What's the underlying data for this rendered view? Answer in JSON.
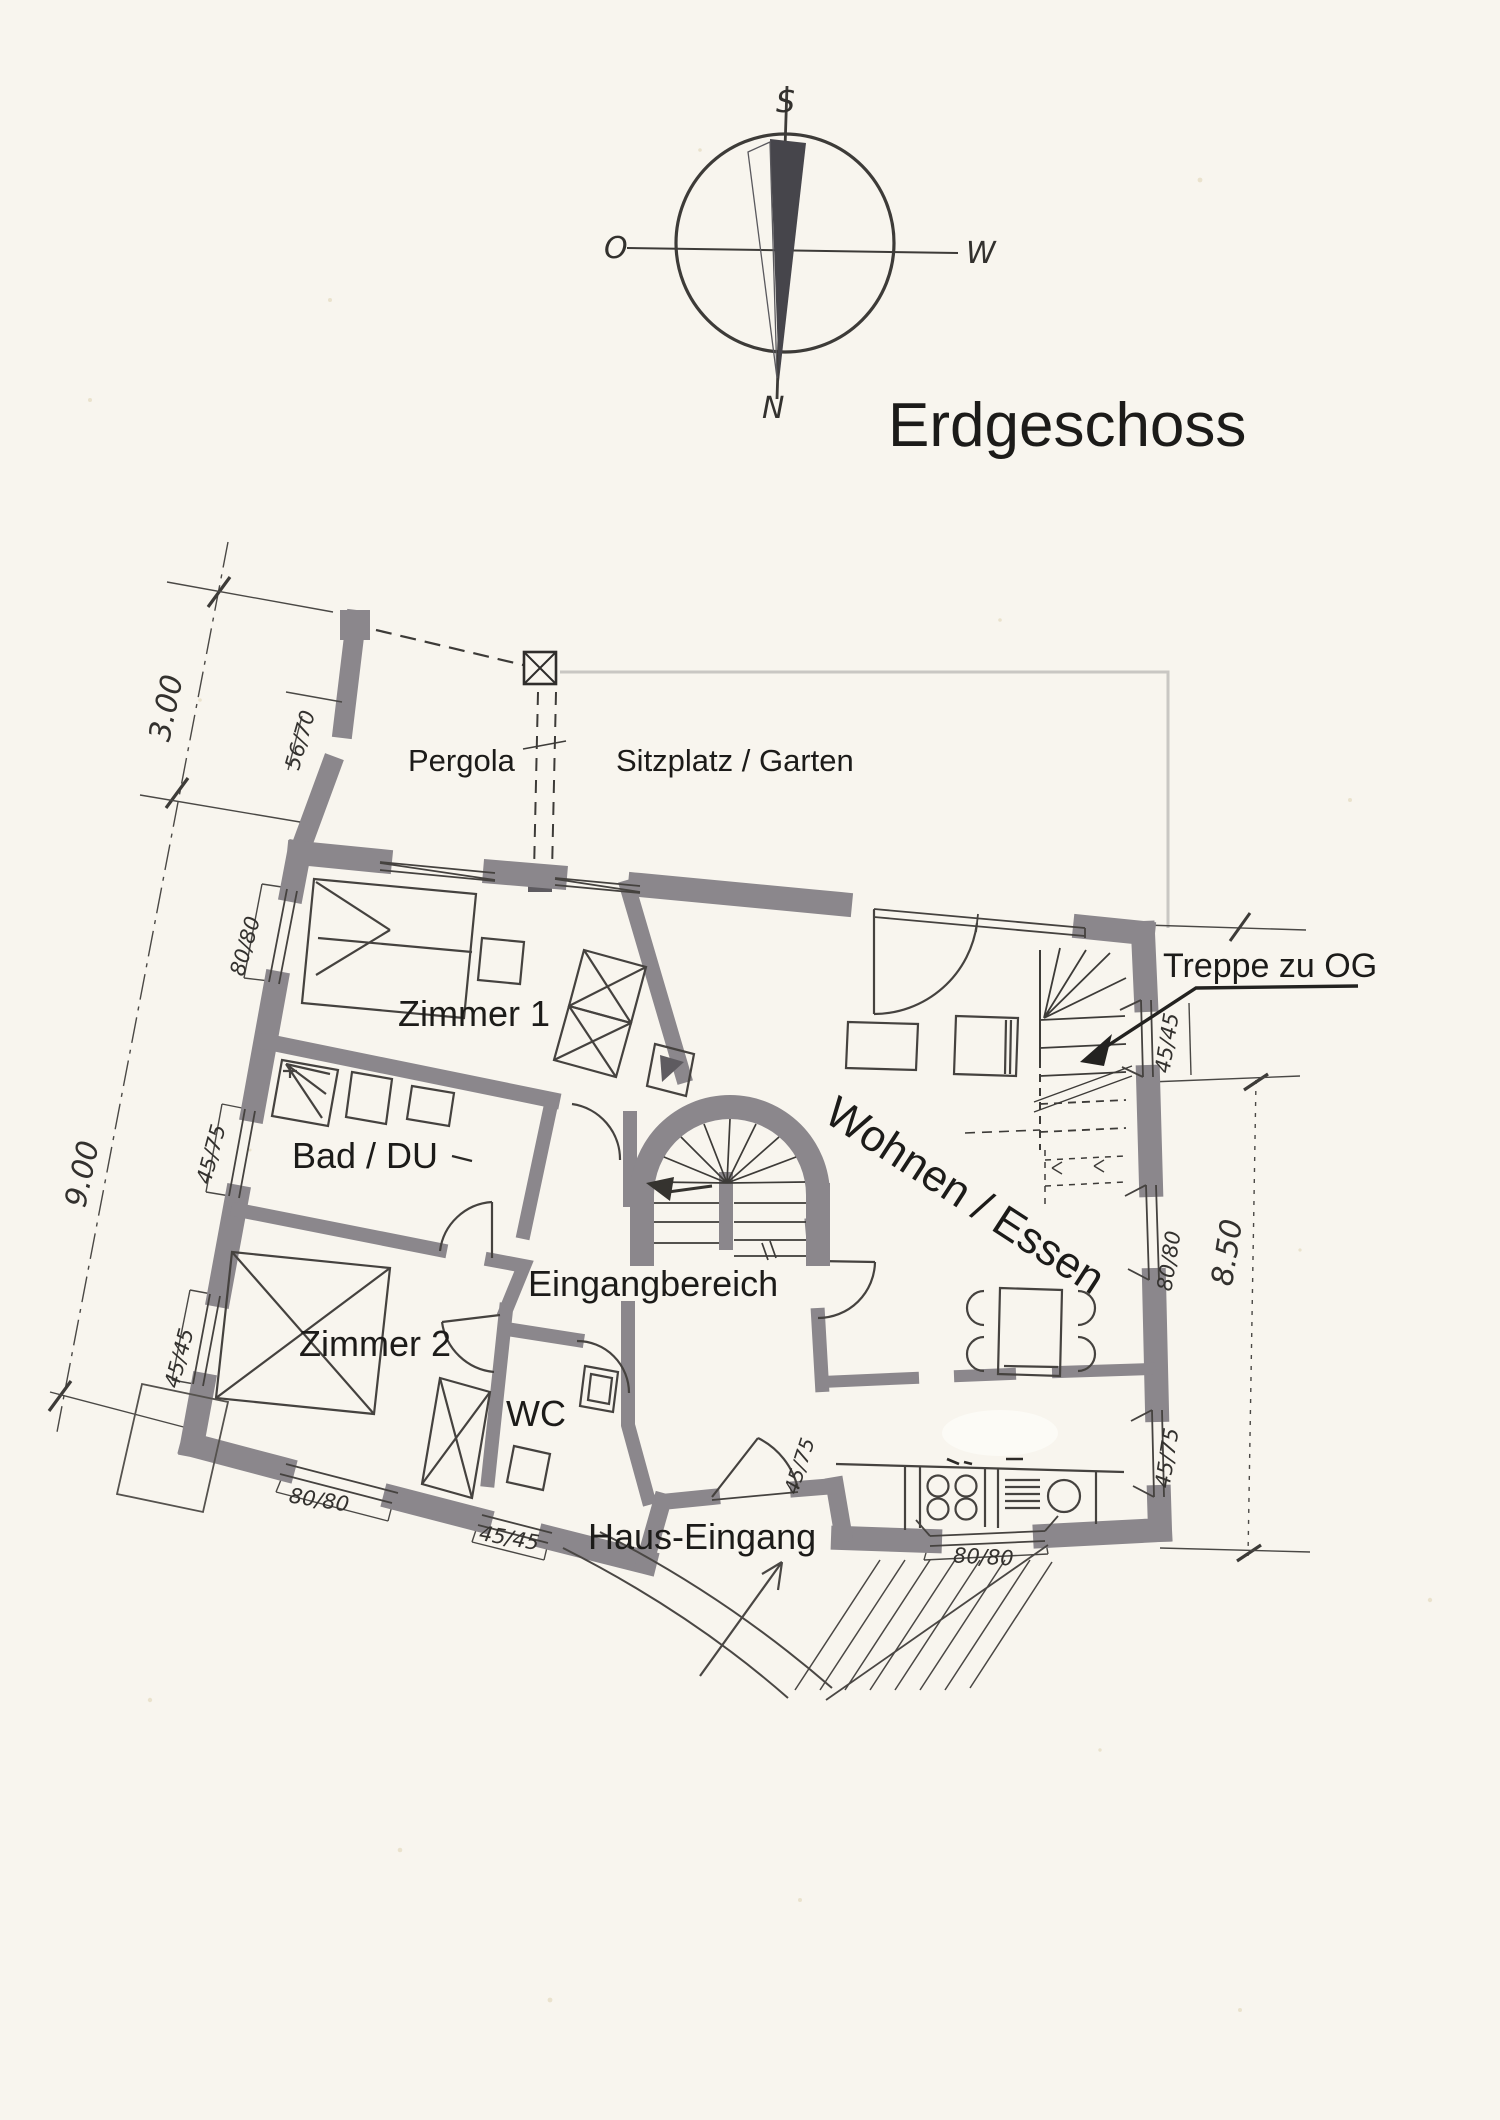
{
  "title": "Erdgeschoss",
  "compass": {
    "top": "S",
    "left": "O",
    "right": "W",
    "bottom": "N"
  },
  "outdoor": {
    "pergola": "Pergola",
    "garden": "Sitzplatz / Garten"
  },
  "rooms": {
    "zimmer1": "Zimmer 1",
    "bad": "Bad / DU",
    "zimmer2": "Zimmer 2",
    "wc": "WC",
    "eingangbereich": "Eingangbereich",
    "wohnen_essen": "Wohnen / Essen",
    "haus_eingang": "Haus-Eingang",
    "treppe_og": "Treppe zu OG"
  },
  "dimensions": {
    "pergola_depth": "3.00",
    "west_length": "9.00",
    "east_length": "8.50",
    "pergola_post": "56/70",
    "west_window_1": "80/80",
    "west_window_2": "45/75",
    "west_window_3": "45/45",
    "south_window_1": "80/80",
    "south_window_2": "45/45",
    "entry_door": "45/75",
    "south_window_3": "80/80",
    "east_window_1": "45/45",
    "east_window_2": "80/80",
    "east_window_3": "45/75"
  },
  "colors": {
    "paper": "#f8f5ee",
    "wall_gray": "#8b878c",
    "ink": "#3d3b38",
    "garden_outline": "#c9c7c3",
    "needle_dark": "#46454b"
  }
}
